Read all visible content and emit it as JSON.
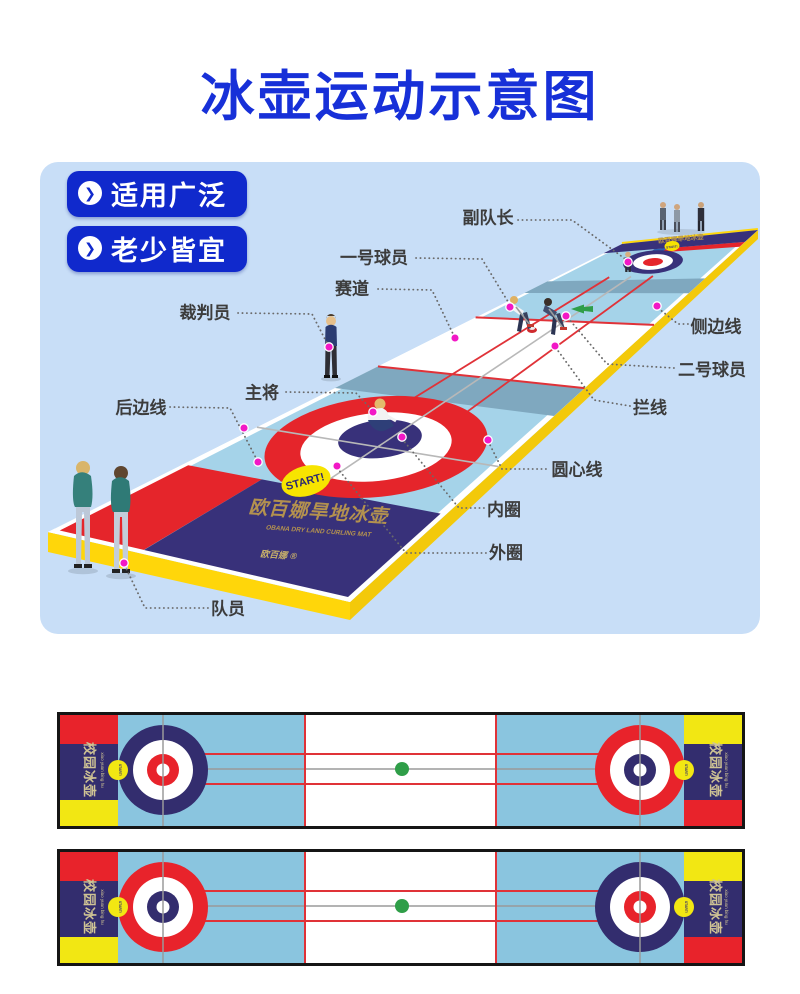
{
  "title": {
    "text": "冰壶运动示意图"
  },
  "badges": [
    {
      "label": "适用广泛",
      "arrow": "❯"
    },
    {
      "label": "老少皆宜",
      "arrow": "❯"
    }
  ],
  "diagram": {
    "labels": [
      {
        "text": "副队长"
      },
      {
        "text": "一号球员"
      },
      {
        "text": "赛道"
      },
      {
        "text": "裁判员"
      },
      {
        "text": "侧边线"
      },
      {
        "text": "二号球员"
      },
      {
        "text": "拦线"
      },
      {
        "text": "主将"
      },
      {
        "text": "后边线"
      },
      {
        "text": "圆心线"
      },
      {
        "text": "内圈"
      },
      {
        "text": "外圈"
      },
      {
        "text": "队员"
      }
    ],
    "mat": {
      "brand_cn": "欧百娜旱地冰壶",
      "brand_en": "OBANA DRY LAND CURLING MAT",
      "logo": "欧百娜 ®",
      "start_text": "START!"
    }
  },
  "top_views": {
    "band_cn": "校园冰壶",
    "band_pinyin": "xiao yuan bing hu",
    "start_text": "START!"
  },
  "colors": {
    "title_blue": "#1730d8",
    "badge_blue": "#1029cc",
    "panel_blue": "#c8def7",
    "mat_blue": "#a5d3e9",
    "steel_blue": "#7fa8bf",
    "edge_yellow": "#ffd60a",
    "red": "#e5252b",
    "navy": "#38317a",
    "gold": "#b3914f",
    "magenta": "#f218c6",
    "green": "#2f9e48",
    "tv_blue": "#8ac5df",
    "tv_navy": "#332d6e",
    "tv_red": "#e8232b",
    "tv_yellow": "#f2e713",
    "line_red": "#e03238",
    "line_gray": "#9a9a9a"
  }
}
